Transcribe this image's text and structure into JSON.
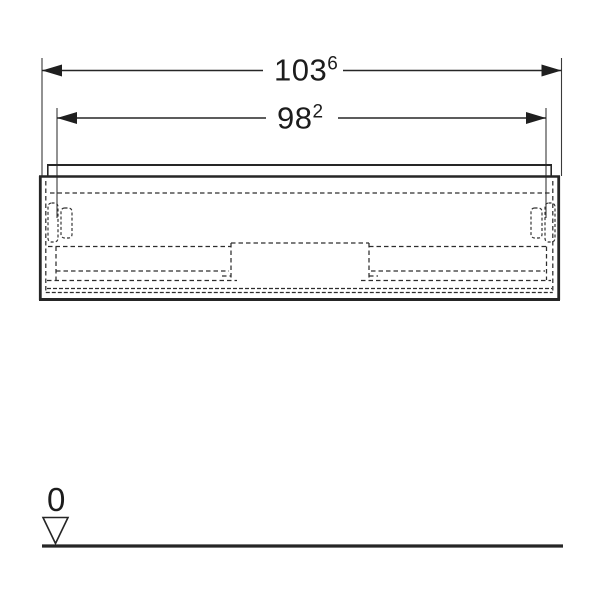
{
  "drawing": {
    "type": "technical-front-elevation",
    "subject": "washbasin cabinet with two drawers, hidden edges dashed, zero floor level datum"
  },
  "dimensions": {
    "overall_width": {
      "value": "103",
      "superscript": "6"
    },
    "inner_width": {
      "value": "98",
      "superscript": "2"
    }
  },
  "datum": {
    "label": "0"
  },
  "icons": {
    "arrowhead_left": "◀",
    "arrowhead_right": "▶",
    "datum_triangle": "▽"
  },
  "colors": {
    "background": "#ffffff",
    "line": "#262626",
    "hidden_line": "#2d2d2d",
    "text": "#1c1c1c"
  }
}
